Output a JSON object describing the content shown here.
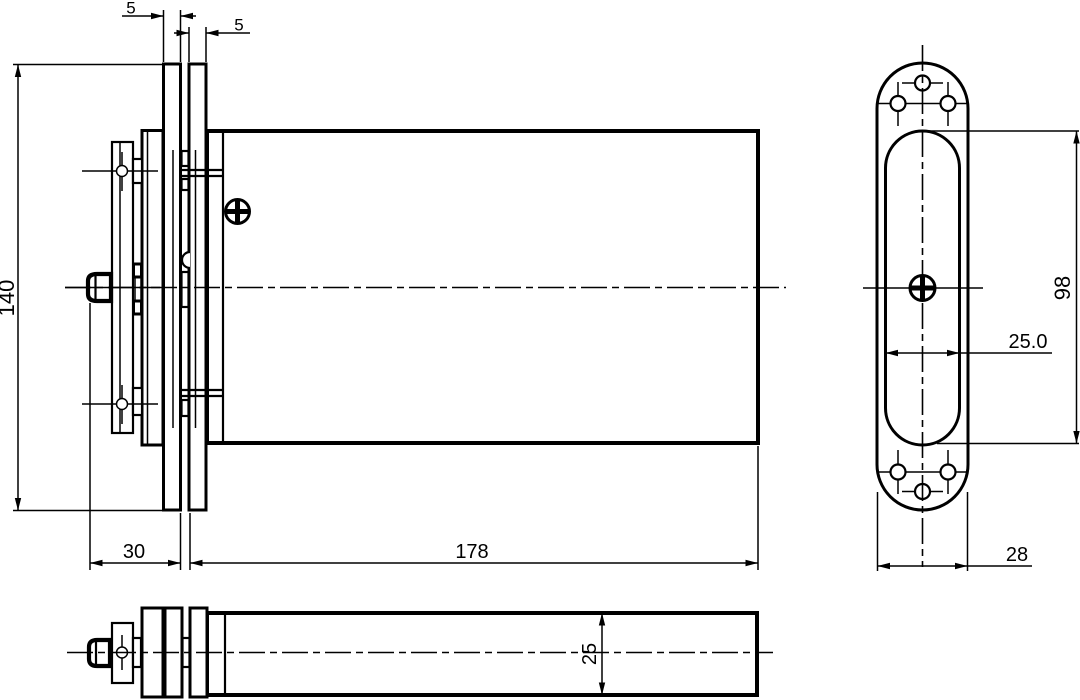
{
  "drawing": {
    "background_color": "#ffffff",
    "line_color": "#000000",
    "dims": {
      "front_plate1_thickness": "5",
      "front_plate2_thickness": "5",
      "front_overall_height": "140",
      "front_mount_offset": "30",
      "front_body_length": "178",
      "side_slot_height": "98",
      "side_slot_width": "25.0",
      "side_plate_width": "28",
      "top_body_height": "25"
    },
    "icons": {
      "phillips_screw": "circle with cross",
      "screw_hole": "small circle with crosshair",
      "centerline": "dash-dot line"
    }
  }
}
